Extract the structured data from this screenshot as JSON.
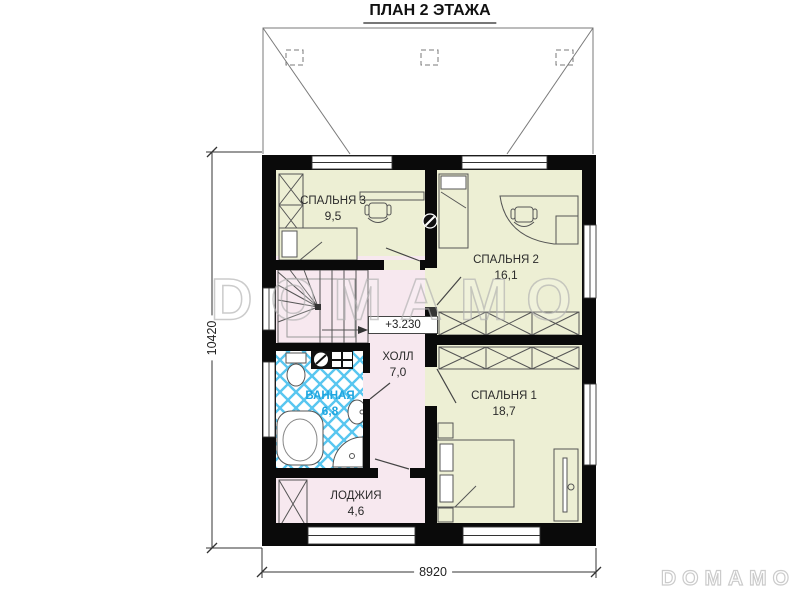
{
  "title": "ПЛАН 2 ЭТАЖА",
  "rooms": [
    {
      "name": "СПАЛЬНЯ 3",
      "area": "9,5"
    },
    {
      "name": "СПАЛЬНЯ 2",
      "area": "16,1"
    },
    {
      "name": "СПАЛЬНЯ 1",
      "area": "18,7"
    },
    {
      "name": "ХОЛЛ",
      "area": "7,0"
    },
    {
      "name": "ВАННАЯ",
      "area": "6,8"
    },
    {
      "name": "ЛОДЖИЯ",
      "area": "4,6"
    }
  ],
  "elevation_mark": "+3.230",
  "dimensions": {
    "width": "8920",
    "height": "10420"
  },
  "watermark": "DOMAMO",
  "colors": {
    "wall": "#0a0a0a",
    "bedroom_fill": "#edefd4",
    "hall_fill": "#f7e8ef",
    "tile_blue": "#58c6f0",
    "bathroom_label": "#1fa6e0"
  }
}
